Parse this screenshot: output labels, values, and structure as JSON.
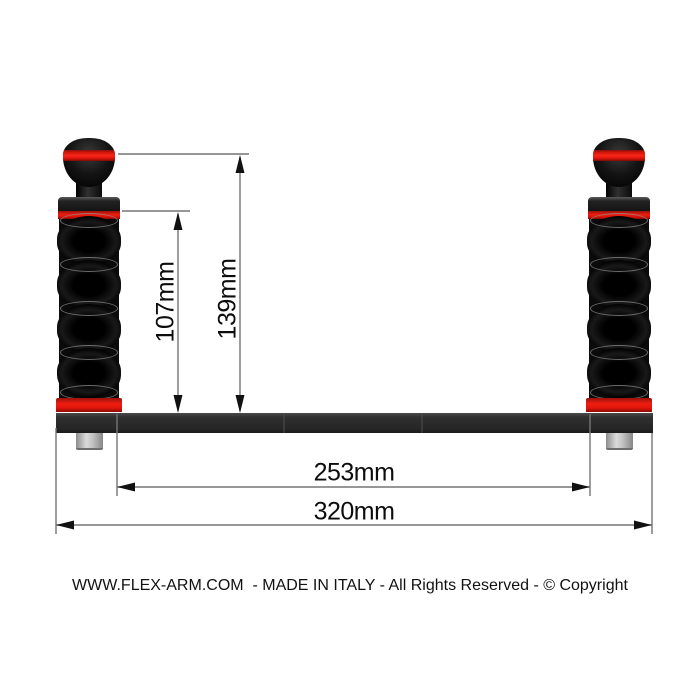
{
  "product": {
    "name": "dual flex-arm camera tray diagram",
    "colors": {
      "red_band": "#ee1d10",
      "arm_black": "#0b0b0b",
      "tray_gray": "#2a2a2a",
      "bolt_gray": "#c4c4c4",
      "dim_line_gray": "#757575",
      "text_black": "#0d0d0d",
      "background": "#ffffff"
    }
  },
  "dimensions": {
    "arm_height_inner": {
      "label": "107mm"
    },
    "arm_height_outer": {
      "label": "139mm"
    },
    "span_inner": {
      "label": "253mm"
    },
    "span_outer": {
      "label": "320mm"
    }
  },
  "footer": {
    "text": "WWW.FLEX-ARM.COM  - MADE IN ITALY - All Rights Reserved - © Copyright"
  }
}
